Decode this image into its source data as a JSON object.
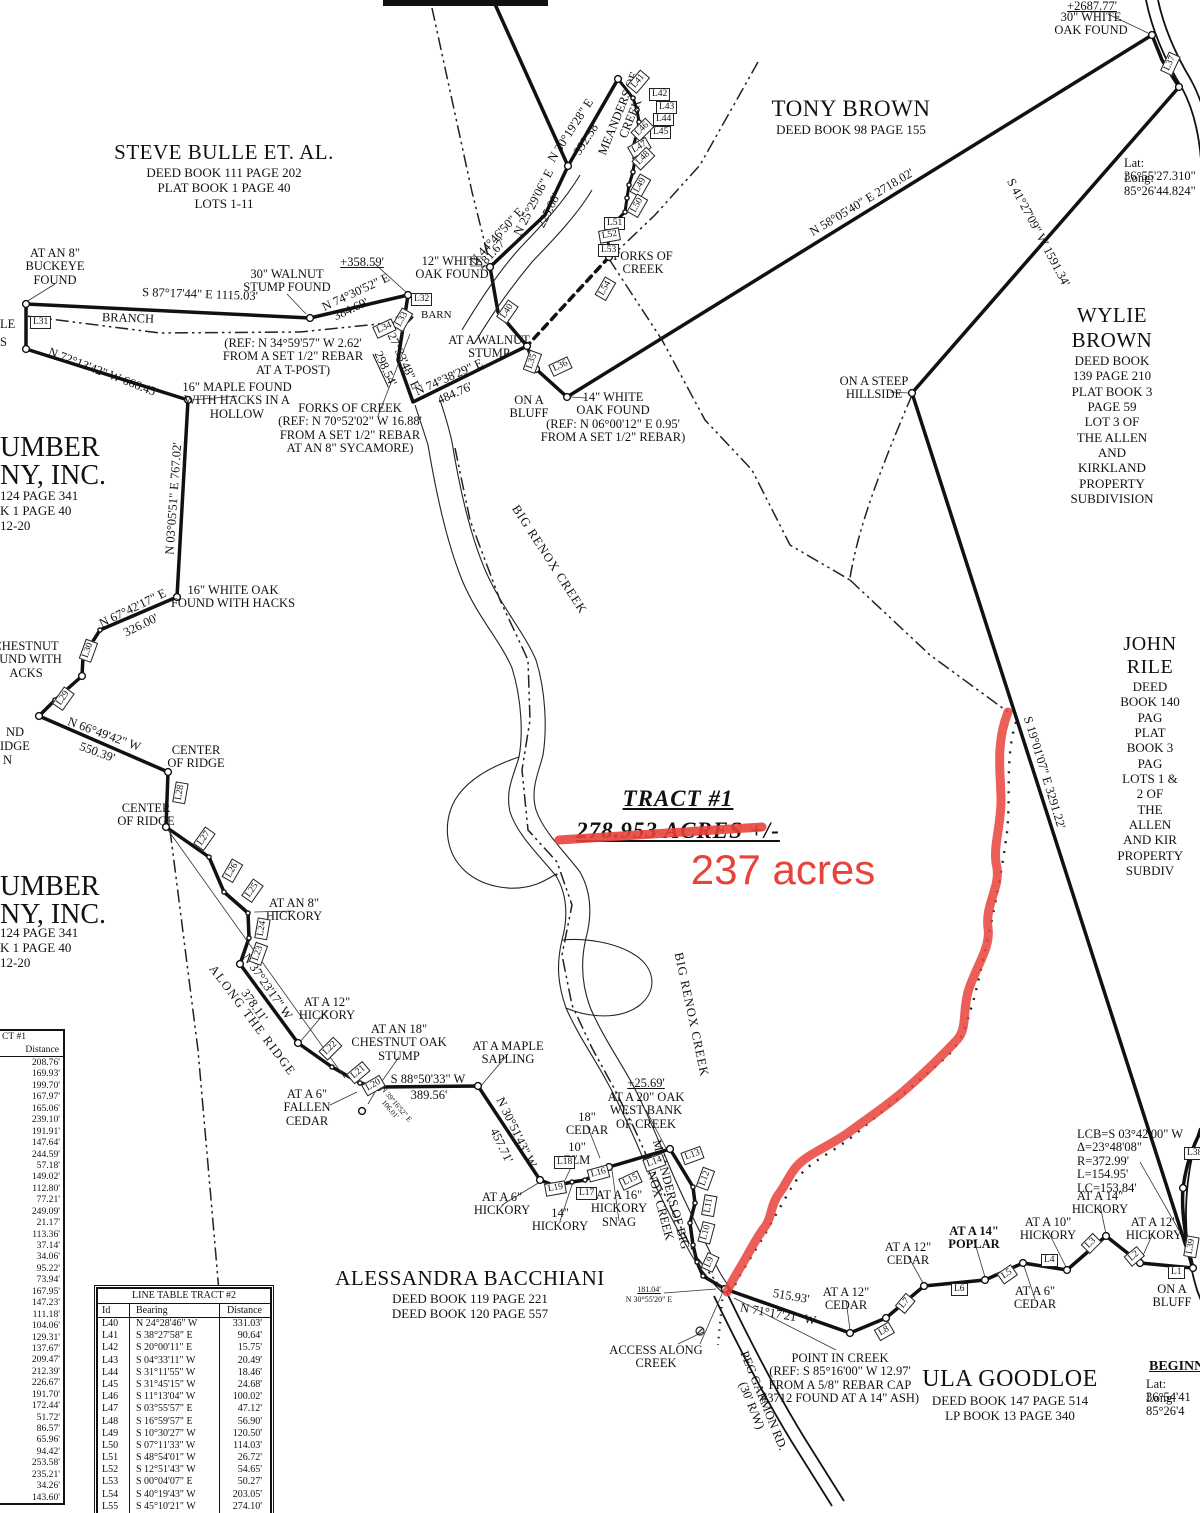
{
  "tract": {
    "title": "TRACT #1",
    "acres_text": "278.953 ACRES +/-",
    "annotation": "237 acres",
    "annotation_color": "#e8433b"
  },
  "owners": [
    {
      "name": "STEVE BULLE ET. AL.",
      "lines": [
        "DEED BOOK 111 PAGE 202",
        "PLAT BOOK 1 PAGE 40",
        "LOTS 1-11"
      ],
      "x": 224,
      "y": 140,
      "ns": 21
    },
    {
      "name": "TONY BROWN",
      "lines": [
        "DEED BOOK 98 PAGE 155"
      ],
      "x": 851,
      "y": 96,
      "ns": 23
    },
    {
      "name": "WYLIE BROWN",
      "lines": [
        "DEED BOOK 139 PAGE 210",
        "PLAT BOOK 3 PAGE 59",
        "LOT 3 OF",
        "THE ALLEN AND KIRKLAND",
        "PROPERTY SUBDIVISION"
      ],
      "x": 1112,
      "y": 303,
      "ns": 21
    },
    {
      "name": "JOHN RILE",
      "lines": [
        "DEED BOOK 140 PAG",
        "PLAT BOOK 3 PAG",
        "LOTS 1 & 2 OF",
        "THE ALLEN AND KIR",
        "PROPERTY SUBDIV"
      ],
      "x": 1150,
      "y": 633,
      "ns": 20
    },
    {
      "name": "ALESSANDRA BACCHIANI",
      "lines": [
        "DEED BOOK 119 PAGE 221",
        "DEED BOOK 120 PAGE 557"
      ],
      "x": 470,
      "y": 1266,
      "ns": 21
    },
    {
      "name": "ULA GOODLOE",
      "lines": [
        "DEED BOOK 147 PAGE 514",
        "LP BOOK 13 PAGE 340"
      ],
      "x": 1010,
      "y": 1366,
      "ns": 24
    }
  ],
  "map_labels": [
    {
      "t": "AT AN 8\"\nBUCKEYE\nFOUND",
      "x": 55,
      "y": 247,
      "n": "buckeye-found-label"
    },
    {
      "t": "S 87°17'44\" E    1115.03'",
      "x": 200,
      "y": 288,
      "r": 2
    },
    {
      "t": "BRANCH",
      "x": 128,
      "y": 312,
      "r": 2
    },
    {
      "t": "30\" WALNUT\nSTUMP FOUND",
      "x": 287,
      "y": 268
    },
    {
      "t": "+358.59'",
      "x": 362,
      "y": 256,
      "u": 1
    },
    {
      "t": "N 74°30'52\" E",
      "x": 356,
      "y": 286,
      "r": -25
    },
    {
      "t": "384.69'",
      "x": 351,
      "y": 303,
      "r": -25
    },
    {
      "t": "(REF: N 34°59'57\" W 2.62'\nFROM A SET 1/2\" REBAR\nAT A T-POST)",
      "x": 293,
      "y": 337
    },
    {
      "t": "N 72°13'42\" W   666.45'",
      "x": 103,
      "y": 366,
      "r": 21
    },
    {
      "t": "16\" MAPLE FOUND\nWITH HACKS IN A\nHOLLOW",
      "x": 237,
      "y": 381
    },
    {
      "t": "FORKS OF CREEK\n(REF: N 70°52'02\" W 16.88'\nFROM A SET 1/2\" REBAR\nAT AN 8\" SYCAMORE)",
      "x": 350,
      "y": 402
    },
    {
      "t": "S 27°33'48\" E",
      "x": 401,
      "y": 350,
      "r": 65
    },
    {
      "t": "298.54'",
      "x": 385,
      "y": 362,
      "r": 65,
      "u": 1
    },
    {
      "t": "12\" WHITE\nOAK FOUND",
      "x": 452,
      "y": 255
    },
    {
      "t": "N 44°46'50\" E",
      "x": 497,
      "y": 230,
      "r": -47
    },
    {
      "t": "281.67'",
      "x": 492,
      "y": 247,
      "r": -47
    },
    {
      "t": "N 25°29'06\" E",
      "x": 534,
      "y": 196,
      "r": -63
    },
    {
      "t": "225.08'",
      "x": 549,
      "y": 204,
      "r": -63
    },
    {
      "t": "N 30°19'28\" E",
      "x": 571,
      "y": 124,
      "r": -57
    },
    {
      "t": "392.58'",
      "x": 587,
      "y": 132,
      "r": -57
    },
    {
      "t": "MEANDERS OF\nCREEK",
      "x": 625,
      "y": 103,
      "r": -68
    },
    {
      "t": "FORKS OF\nCREEK",
      "x": 643,
      "y": 250
    },
    {
      "t": "AT A WALNUT\nSTUMP",
      "x": 489,
      "y": 334
    },
    {
      "t": "N 74°38'29\" E",
      "x": 449,
      "y": 371,
      "r": -24
    },
    {
      "t": "484.76'",
      "x": 455,
      "y": 387,
      "r": -24
    },
    {
      "t": "ON A\nBLUFF",
      "x": 529,
      "y": 394
    },
    {
      "t": "14\" WHITE\nOAK FOUND\n(REF: N 06°00'12\" E 0.95'\nFROM A SET 1/2\" REBAR)",
      "x": 613,
      "y": 391
    },
    {
      "t": "+2687.77'",
      "x": 1092,
      "y": 0,
      "u": 1
    },
    {
      "t": "30\" WHITE\nOAK FOUND",
      "x": 1091,
      "y": 11
    },
    {
      "t": "Lat: 36°55'27.310\"",
      "x": 1124,
      "y": 157,
      "al": "l"
    },
    {
      "t": "Long: 85°26'44.824\"",
      "x": 1124,
      "y": 172,
      "al": "l"
    },
    {
      "t": "N 58°05'40\" E    2718.02'",
      "x": 862,
      "y": 196,
      "r": -31
    },
    {
      "t": "S 41°27'09\" W    1591.34'",
      "x": 1038,
      "y": 226,
      "r": 62
    },
    {
      "t": "ON A STEEP\nHILLSIDE",
      "x": 874,
      "y": 375
    },
    {
      "t": "S 19°01'07\" E    3291.22'",
      "x": 1044,
      "y": 766,
      "r": 73
    },
    {
      "t": "N 03°05'51\" E    767.02'",
      "x": 174,
      "y": 492,
      "r": -86
    },
    {
      "t": "16\" WHITE OAK\nFOUND WITH HACKS",
      "x": 233,
      "y": 584
    },
    {
      "t": "N 67°42'17\" E",
      "x": 133,
      "y": 602,
      "r": -26
    },
    {
      "t": "326.00'",
      "x": 141,
      "y": 619,
      "r": -26
    },
    {
      "t": "CHESTNUT\nOUND WITH\nACKS",
      "x": 26,
      "y": 640
    },
    {
      "t": "N 66°49'42\" W",
      "x": 104,
      "y": 728,
      "r": 20
    },
    {
      "t": "550.39'",
      "x": 97,
      "y": 746,
      "r": 20
    },
    {
      "t": "CENTER\nOF RIDGE",
      "x": 196,
      "y": 744
    },
    {
      "t": "CENTER\nOF RIDGE",
      "x": 146,
      "y": 802
    },
    {
      "t": "ND",
      "x": 6,
      "y": 726,
      "al": "l"
    },
    {
      "t": "IDGE",
      "x": 0,
      "y": 740,
      "al": "l"
    },
    {
      "t": "N",
      "x": 3,
      "y": 754,
      "al": "l"
    },
    {
      "t": "LE",
      "x": 0,
      "y": 318,
      "al": "l"
    },
    {
      "t": "S",
      "x": 0,
      "y": 336,
      "al": "l"
    },
    {
      "t": "UMBER",
      "x": 0,
      "y": 433,
      "s": 28,
      "al": "l"
    },
    {
      "t": "NY, INC.",
      "x": 0,
      "y": 461,
      "s": 28,
      "al": "l"
    },
    {
      "t": "124 PAGE 341",
      "x": 0,
      "y": 489,
      "s": 13,
      "al": "l"
    },
    {
      "t": "K 1 PAGE 40",
      "x": 0,
      "y": 504,
      "s": 13,
      "al": "l"
    },
    {
      "t": "12-20",
      "x": 0,
      "y": 519,
      "s": 13,
      "al": "l"
    },
    {
      "t": "UMBER",
      "x": 0,
      "y": 872,
      "s": 28,
      "al": "l"
    },
    {
      "t": "NY, INC.",
      "x": 0,
      "y": 900,
      "s": 28,
      "al": "l"
    },
    {
      "t": "124 PAGE 341",
      "x": 0,
      "y": 926,
      "s": 13,
      "al": "l"
    },
    {
      "t": "K 1 PAGE 40",
      "x": 0,
      "y": 941,
      "s": 13,
      "al": "l"
    },
    {
      "t": "12-20",
      "x": 0,
      "y": 956,
      "s": 13,
      "al": "l"
    },
    {
      "t": "AT AN 8\"\nHICKORY",
      "x": 294,
      "y": 897
    },
    {
      "t": "ALONG THE RIDGE",
      "x": 252,
      "y": 1014,
      "r": 53,
      "ls": 1.5
    },
    {
      "t": "N 37°23'17\" W",
      "x": 267,
      "y": 980,
      "r": 55
    },
    {
      "t": "378.11'",
      "x": 254,
      "y": 999,
      "r": 55
    },
    {
      "t": "AT A 12\"\nHICKORY",
      "x": 327,
      "y": 996
    },
    {
      "t": "AT AN 18\"\nCHESTNUT OAK\nSTUMP",
      "x": 399,
      "y": 1023
    },
    {
      "t": "AT A MAPLE\nSAPLING",
      "x": 508,
      "y": 1040
    },
    {
      "t": "S 88°50'33\" W",
      "x": 428,
      "y": 1073
    },
    {
      "t": "389.56'",
      "x": 429,
      "y": 1089
    },
    {
      "t": "AT A 6\"\nFALLEN\nCEDAR",
      "x": 307,
      "y": 1088
    },
    {
      "t": "N 39°16'52\" E\n106.01'",
      "x": 393,
      "y": 1099,
      "r": 50,
      "s": 7.5
    },
    {
      "t": "N 30°51'43\" W",
      "x": 516,
      "y": 1126,
      "r": 64
    },
    {
      "t": "457.71'",
      "x": 501,
      "y": 1139,
      "r": 64
    },
    {
      "t": "18\"\nCEDAR",
      "x": 587,
      "y": 1111
    },
    {
      "t": "10\"\nELM",
      "x": 577,
      "y": 1141
    },
    {
      "t": "AT A 6\"\nHICKORY",
      "x": 502,
      "y": 1191
    },
    {
      "t": "14\"\nHICKORY",
      "x": 560,
      "y": 1207
    },
    {
      "t": "AT A 16\"\nHICKORY\nSNAG",
      "x": 619,
      "y": 1189
    },
    {
      "t": "+25.69'",
      "x": 646,
      "y": 1077,
      "u": 1
    },
    {
      "t": "AT A 20\" OAK\nWEST BANK\nOF CREEK",
      "x": 646,
      "y": 1091
    },
    {
      "t": "MEANDERS OF BIG\nRENOX CREEK",
      "x": 664,
      "y": 1183,
      "r": 75
    },
    {
      "t": "BIG RENOX CREEK",
      "x": 549,
      "y": 553,
      "r": 57,
      "ls": 1
    },
    {
      "t": "BIG RENOX CREEK",
      "x": 691,
      "y": 1008,
      "r": 78,
      "ls": 1
    },
    {
      "t": "ACCESS ALONG\nCREEK",
      "x": 656,
      "y": 1344
    },
    {
      "t": "181.04'",
      "x": 649,
      "y": 1286,
      "s": 8,
      "u": 1
    },
    {
      "t": "N 30°55'20\" E",
      "x": 649,
      "y": 1296,
      "s": 8
    },
    {
      "t": "N 71°17'21\" W",
      "x": 778,
      "y": 1308,
      "r": 10
    },
    {
      "t": "515.93'",
      "x": 791,
      "y": 1290,
      "r": 10
    },
    {
      "t": "PEG GARMON RD.\n(30' R/W)",
      "x": 757,
      "y": 1390,
      "r": 68
    },
    {
      "t": "POINT IN CREEK\n(REF: S 85°16'00\" W 12.97'\nFROM A 5/8\" REBAR CAP\n#3712 FOUND AT A 14\" ASH)",
      "x": 840,
      "y": 1352
    },
    {
      "t": "AT A 12\"\nCEDAR",
      "x": 846,
      "y": 1286
    },
    {
      "t": "AT A 12\"\nCEDAR",
      "x": 908,
      "y": 1241
    },
    {
      "t": "AT A 14\"\nPOPLAR",
      "x": 974,
      "y": 1225,
      "b": 1
    },
    {
      "t": "AT A 6\"\nCEDAR",
      "x": 1035,
      "y": 1285
    },
    {
      "t": "AT A 10\"\nHICKORY",
      "x": 1048,
      "y": 1216
    },
    {
      "t": "AT A 14\"\nHICKORY",
      "x": 1100,
      "y": 1190
    },
    {
      "t": "AT A 12\"\nHICKORY",
      "x": 1154,
      "y": 1216
    },
    {
      "t": "ON A\nBLUFF",
      "x": 1172,
      "y": 1283
    },
    {
      "t": "LCB=S 03°42'00\" W\nΔ=23°48'08\"\nR=372.99'\nL=154.95'\nLC=153.84'",
      "x": 1077,
      "y": 1128,
      "al": "l"
    },
    {
      "t": "BARN",
      "x": 421,
      "y": 310,
      "al": "l",
      "s": 11
    },
    {
      "t": "BEGINN",
      "x": 1149,
      "y": 1360,
      "b": 1,
      "u": 1,
      "s": 14,
      "al": "l"
    },
    {
      "t": "Lat: 36°54'41",
      "x": 1146,
      "y": 1378,
      "al": "l"
    },
    {
      "t": "Long: 85°26'4",
      "x": 1146,
      "y": 1392,
      "al": "l"
    }
  ],
  "line_boxes": [
    {
      "id": "L1",
      "x": 1168,
      "y": 1266
    },
    {
      "id": "L2",
      "x": 1126,
      "y": 1250,
      "r": -40
    },
    {
      "id": "L3",
      "x": 1083,
      "y": 1237,
      "r": -45
    },
    {
      "id": "L4",
      "x": 1041,
      "y": 1254
    },
    {
      "id": "L5",
      "x": 999,
      "y": 1268,
      "r": -35
    },
    {
      "id": "L6",
      "x": 951,
      "y": 1283
    },
    {
      "id": "L7",
      "x": 897,
      "y": 1297,
      "r": -50
    },
    {
      "id": "L8",
      "x": 876,
      "y": 1325,
      "r": -30
    },
    {
      "id": "L9",
      "x": 702,
      "y": 1256,
      "r": -65
    },
    {
      "id": "L10",
      "x": 696,
      "y": 1226,
      "r": -75
    },
    {
      "id": "L11",
      "x": 699,
      "y": 1199,
      "r": -80
    },
    {
      "id": "L12",
      "x": 695,
      "y": 1172,
      "r": -70
    },
    {
      "id": "L13",
      "x": 682,
      "y": 1149,
      "r": -20
    },
    {
      "id": "L14",
      "x": 644,
      "y": 1156,
      "r": -20
    },
    {
      "id": "L15",
      "x": 620,
      "y": 1174,
      "r": -25
    },
    {
      "id": "L16",
      "x": 588,
      "y": 1167,
      "r": -15
    },
    {
      "id": "L17",
      "x": 576,
      "y": 1187
    },
    {
      "id": "L18",
      "x": 554,
      "y": 1156
    },
    {
      "id": "L19",
      "x": 545,
      "y": 1182,
      "r": -10
    },
    {
      "id": "L20",
      "x": 363,
      "y": 1079,
      "r": -30
    },
    {
      "id": "L21",
      "x": 348,
      "y": 1066,
      "r": -40
    },
    {
      "id": "L22",
      "x": 320,
      "y": 1042,
      "r": -45
    },
    {
      "id": "L23",
      "x": 248,
      "y": 947,
      "r": -70
    },
    {
      "id": "L24",
      "x": 252,
      "y": 922,
      "r": -80
    },
    {
      "id": "L25",
      "x": 242,
      "y": 884,
      "r": -55
    },
    {
      "id": "L26",
      "x": 222,
      "y": 864,
      "r": -60
    },
    {
      "id": "L27",
      "x": 194,
      "y": 832,
      "r": -55
    },
    {
      "id": "L28",
      "x": 170,
      "y": 786,
      "r": -80
    },
    {
      "id": "L29",
      "x": 53,
      "y": 692,
      "r": -55
    },
    {
      "id": "L30",
      "x": 78,
      "y": 644,
      "r": -70
    },
    {
      "id": "L31",
      "x": 30,
      "y": 316
    },
    {
      "id": "L32",
      "x": 411,
      "y": 293
    },
    {
      "id": "L33",
      "x": 392,
      "y": 313,
      "r": -60
    },
    {
      "id": "L34",
      "x": 374,
      "y": 322,
      "r": -25
    },
    {
      "id": "L35",
      "x": 522,
      "y": 355,
      "r": -70
    },
    {
      "id": "L36",
      "x": 550,
      "y": 360,
      "r": -25
    },
    {
      "id": "L37",
      "x": 1160,
      "y": 57,
      "r": -65
    },
    {
      "id": "L38",
      "x": 1184,
      "y": 1147
    },
    {
      "id": "L39",
      "x": 1181,
      "y": 1240,
      "r": -80
    },
    {
      "id": "L40",
      "x": 497,
      "y": 305,
      "r": -55
    },
    {
      "id": "L41",
      "x": 628,
      "y": 75,
      "r": -50
    },
    {
      "id": "L42",
      "x": 649,
      "y": 88
    },
    {
      "id": "L43",
      "x": 656,
      "y": 101
    },
    {
      "id": "L44",
      "x": 653,
      "y": 113
    },
    {
      "id": "L45",
      "x": 650,
      "y": 126
    },
    {
      "id": "L46",
      "x": 632,
      "y": 123,
      "r": -45
    },
    {
      "id": "L47",
      "x": 629,
      "y": 141,
      "r": -30
    },
    {
      "id": "L48",
      "x": 633,
      "y": 152,
      "r": -45
    },
    {
      "id": "L49",
      "x": 630,
      "y": 179,
      "r": -60
    },
    {
      "id": "L50",
      "x": 627,
      "y": 199,
      "r": -60
    },
    {
      "id": "L51",
      "x": 604,
      "y": 217
    },
    {
      "id": "L52",
      "x": 599,
      "y": 229,
      "r": -10
    },
    {
      "id": "L53",
      "x": 598,
      "y": 244
    },
    {
      "id": "L54",
      "x": 595,
      "y": 282,
      "r": -60
    }
  ],
  "tables": {
    "tract1": {
      "title_fragment": "CT #1",
      "distance_header": "Distance",
      "distances": [
        "208.76'",
        "169.93'",
        "199.70'",
        "167.97'",
        "165.06'",
        "239.10'",
        "191.91'",
        "147.64'",
        "244.59'",
        "57.18'",
        "149.02'",
        "112.80'",
        "77.21'",
        "249.09'",
        "21.17'",
        "113.36'",
        "37.14'",
        "34.06'",
        "95.22'",
        "73.94'",
        "167.95'",
        "147.23'",
        "111.18'",
        "104.06'",
        "129.31'",
        "137.67'",
        "209.47'",
        "212.39'",
        "226.67'",
        "191.70'",
        "172.44'",
        "51.72'",
        "86.57'",
        "65.96'",
        "94.42'",
        "253.58'",
        "235.21'",
        "34.26'",
        "143.60'"
      ]
    },
    "tract2": {
      "title": "LINE TABLE TRACT #2",
      "headers": [
        "Id",
        "Bearing",
        "Distance"
      ],
      "rows": [
        [
          "L40",
          "N 24°28'46\" W",
          "331.03'"
        ],
        [
          "L41",
          "S 38°27'58\" E",
          "90.64'"
        ],
        [
          "L42",
          "S 20°00'11\" E",
          "15.75'"
        ],
        [
          "L43",
          "S 04°33'11\" W",
          "20.49'"
        ],
        [
          "L44",
          "S 31°11'55\" W",
          "18.46'"
        ],
        [
          "L45",
          "S 31°45'15\" W",
          "24.68'"
        ],
        [
          "L46",
          "S 11°13'04\" W",
          "100.02'"
        ],
        [
          "L47",
          "S 03°55'57\" E",
          "47.12'"
        ],
        [
          "L48",
          "S 16°59'57\" E",
          "56.90'"
        ],
        [
          "L49",
          "S 10°30'27\" W",
          "120.50'"
        ],
        [
          "L50",
          "S 07°11'33\" W",
          "114.03'"
        ],
        [
          "L51",
          "S 48°54'01\" W",
          "26.72'"
        ],
        [
          "L52",
          "S 12°51'43\" W",
          "54.65'"
        ],
        [
          "L53",
          "S 00°04'07\" E",
          "50.27'"
        ],
        [
          "L54",
          "S 40°19'43\" W",
          "203.05'"
        ],
        [
          "L55",
          "S 45°10'21\" W",
          "274.10'"
        ]
      ]
    }
  }
}
